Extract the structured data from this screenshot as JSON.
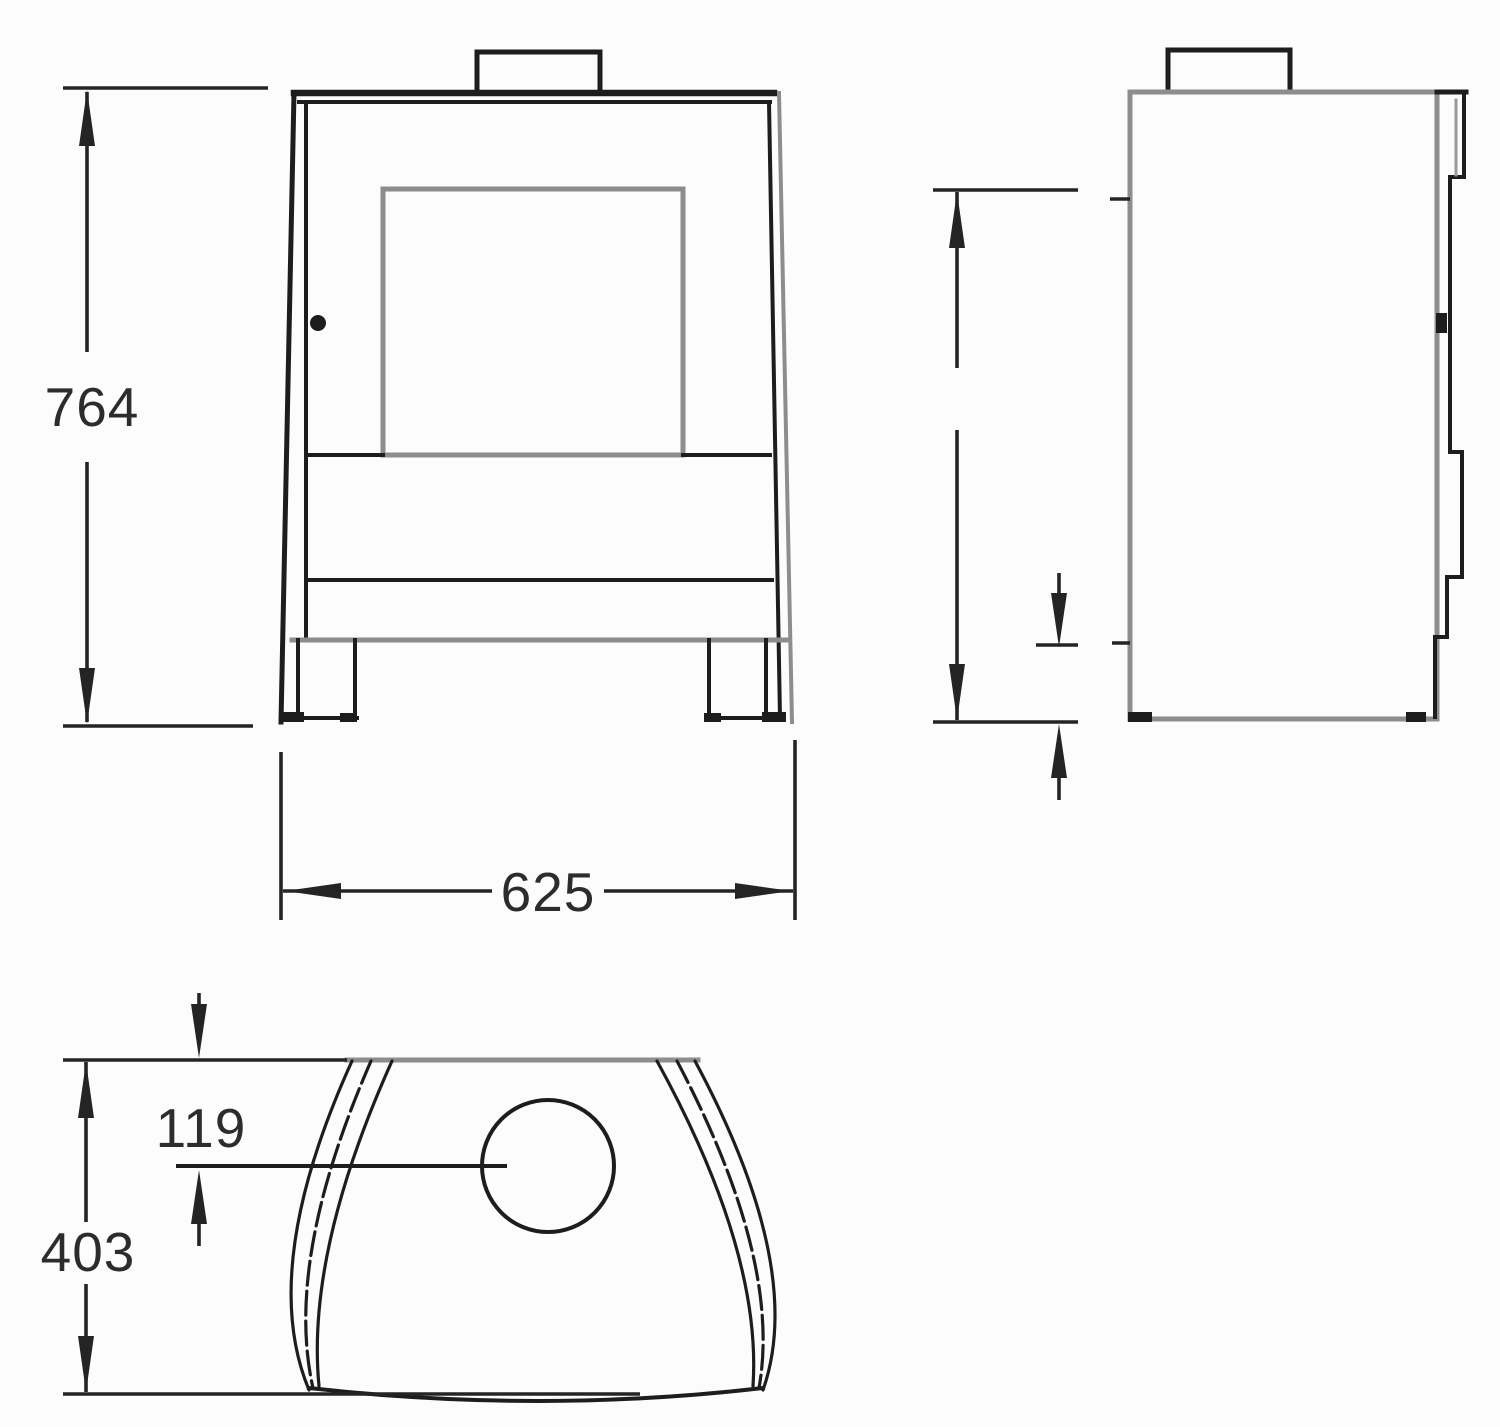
{
  "drawing": {
    "kind": "stove three-view dimension drawing",
    "colors": {
      "background": "#fcfcfc",
      "ink": "#1d1d1d",
      "soft_ink": "#8d8d8d",
      "text": "#2c2c2c"
    },
    "dimensions": {
      "height": {
        "label": "764"
      },
      "width": {
        "label": "625"
      },
      "flue_offset": {
        "label": "119"
      },
      "depth": {
        "label": "403"
      },
      "side_upper": {
        "label": ""
      },
      "side_lower": {
        "label": ""
      }
    }
  }
}
